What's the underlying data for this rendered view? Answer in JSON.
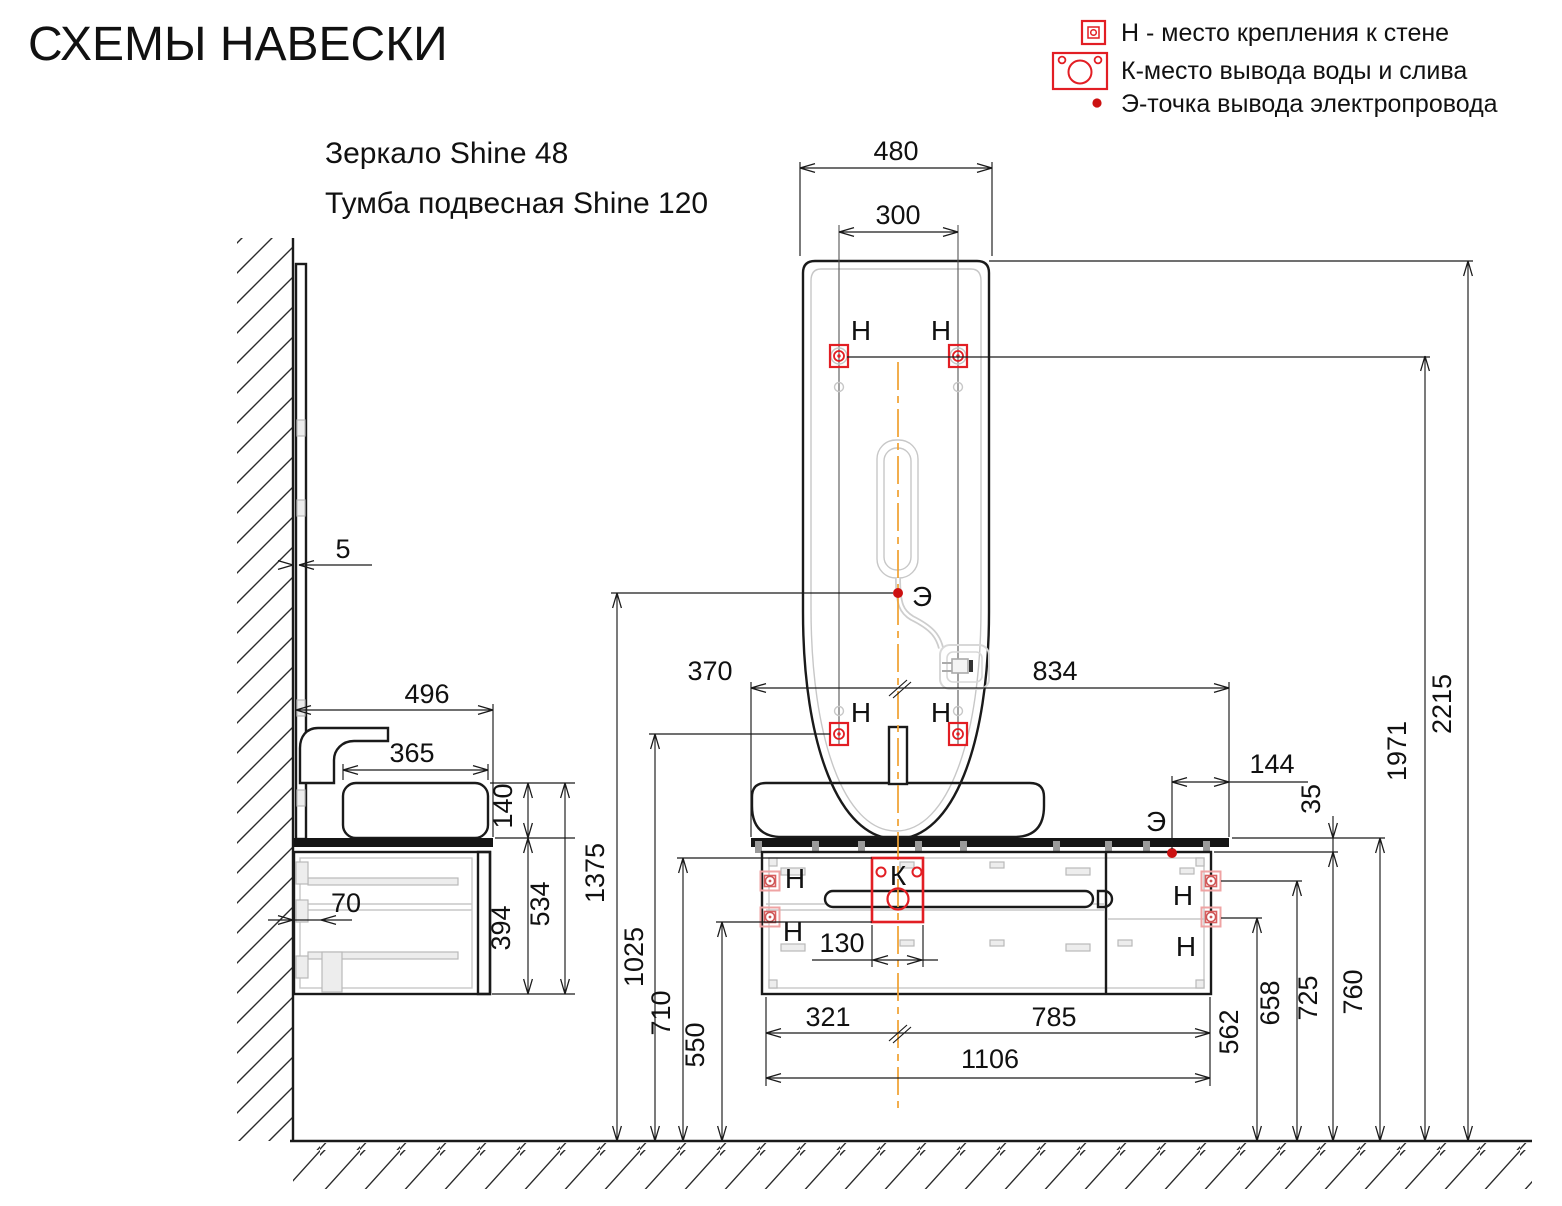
{
  "title": "СХЕМЫ НАВЕСКИ",
  "products": {
    "mirror": "Зеркало Shine 48",
    "vanity": "Тумба подвесная Shine 120"
  },
  "legend": {
    "mount_label": "Н - место крепления к стене",
    "water_label": "К-место вывода воды и слива",
    "electric_label": "Э-точка вывода электропровода"
  },
  "markers": {
    "mount": "Н",
    "water": "К",
    "electric": "Э"
  },
  "dims": {
    "mirror_width": "480",
    "mirror_mount_spacing": "300",
    "wall_gap": "5",
    "countertop_left": "370",
    "countertop_right": "834",
    "electric_offset": "144",
    "countertop_gap": "35",
    "h_mirror_top": "2215",
    "h_mirror_mounts": "1971",
    "h_electric": "1375",
    "h_mirror_lower_mounts": "1025",
    "h_water_top": "710",
    "h_water_bottom": "550",
    "water_width": "130",
    "cabinet_left": "321",
    "cabinet_right": "785",
    "cabinet_width": "1106",
    "h_mount_lower": "562",
    "h_mount_upper": "658",
    "h_cabinet_top": "725",
    "h_countertop": "760",
    "depth_total": "496",
    "sink_depth": "365",
    "sink_height": "140",
    "side_height": "534",
    "cabinet_height": "394",
    "back_offset": "70"
  },
  "colors": {
    "line": "#1a1a1a",
    "red": "#e21e24",
    "orange": "#f0a030",
    "gray": "#c7c7c7"
  }
}
